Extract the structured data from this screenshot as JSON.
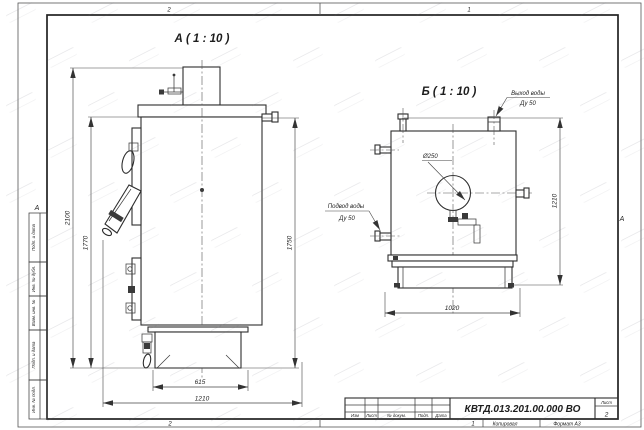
{
  "frame": {
    "zones": {
      "top_left": "2",
      "top_right": "1",
      "bottom_left": "2",
      "bottom_right": "1"
    },
    "fold_marks": {
      "left": "А",
      "right": "А"
    },
    "stamp_fields": [
      "Подп. и дата",
      "Инв. № дубл.",
      "Взам. инв. №",
      "Подп. и дата",
      "Инв. № подл."
    ]
  },
  "view_a": {
    "title": "А ( 1 : 10 )",
    "dim_total_height": "2100",
    "dim_body_height": "1770",
    "dim_right_height": "1750",
    "dim_base_width": "615",
    "dim_total_width": "1210"
  },
  "view_b": {
    "title": "Б ( 1 : 10 )",
    "label_outlet": "Выход воды",
    "label_outlet_dn": "Ду 50",
    "label_inlet": "Подвод воды",
    "label_inlet_dn": "Ду 50",
    "label_diameter": "Ø250",
    "dim_height": "1210",
    "dim_base_depth": "1020"
  },
  "title_block": {
    "doc_number": "КВТД.013.201.00.000 ВО",
    "sheet_label": "Лист",
    "sheet_number": "2",
    "columns": [
      "Изм",
      "Лист",
      "№ докум.",
      "Подп.",
      "Дата"
    ],
    "footer_copy": "Копировал",
    "footer_format": "Формат А3"
  }
}
